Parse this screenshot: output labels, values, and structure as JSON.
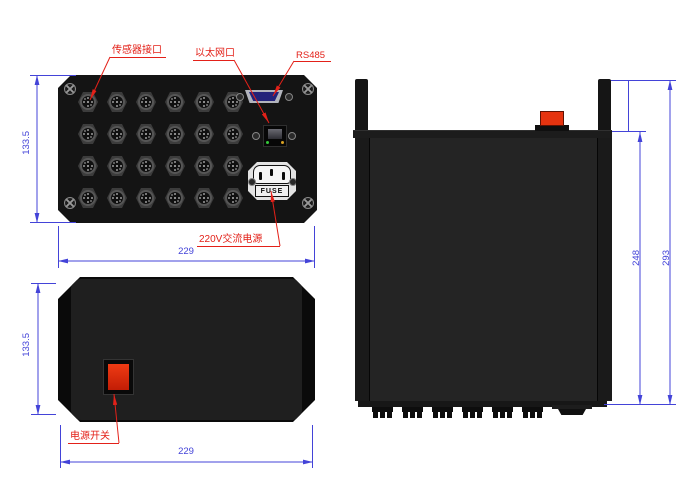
{
  "drawing_title": "enclosure three-view technical drawing",
  "colors": {
    "dimension_blue": "#4343d8",
    "annotation_red": "#e32119",
    "switch_red": "#e5330f",
    "panel_black": "#141414"
  },
  "front_view": {
    "labels": {
      "sensor_port": "传感器接口",
      "ethernet_port": "以太网口",
      "rs485": "RS485",
      "ac_power": "220V交流电源"
    },
    "fuse_text": "FUSE",
    "connector_grid": {
      "rows": 4,
      "cols": 6
    },
    "dimensions": {
      "height": "133.5",
      "width": "229"
    }
  },
  "top_view": {
    "labels": {
      "power_switch": "电源开关"
    },
    "dimensions": {
      "height": "133.5",
      "width": "229"
    }
  },
  "side_view": {
    "bottom_connector_count": 6,
    "dimensions": {
      "inner_height": "248",
      "outer_height": "293"
    }
  }
}
